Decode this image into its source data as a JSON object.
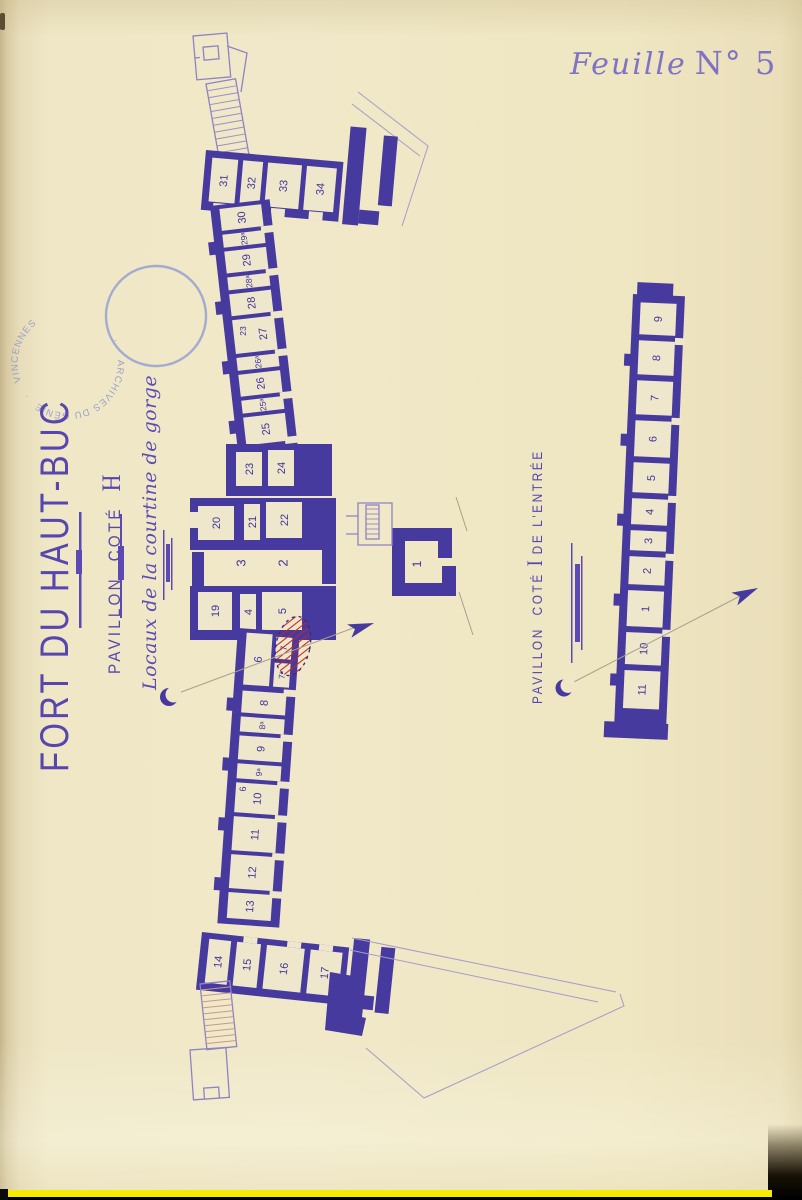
{
  "sheet": {
    "word": "Feuille",
    "number": "N° 5"
  },
  "titles": {
    "fort": "FORT DU HAUT-BUC",
    "pavillon_h": {
      "prefix": "PAVILLON",
      "mid": "COTÉ",
      "letter": "H"
    },
    "locaux": "Locaux de la courtine de gorge",
    "pavillon_i": {
      "prefix": "PAVILLON",
      "mid": "COTÉ",
      "letter": "I",
      "suffix": "DE L'ENTRÉE"
    }
  },
  "stamp": {
    "arc_top": "ARCHIVES DU GÉNIE",
    "arc_bottom": "VINCENNES"
  },
  "colors": {
    "ink": "#473a9e",
    "outline": "#8d83c6",
    "stamp_blue": "#8d97cb",
    "red_hatch": "#c3261d",
    "bottom_yellow": "#f6ea00",
    "paper": "#efe7c6"
  },
  "plans": {
    "groups": [
      {
        "id": "top-cluster",
        "t": "translate(206,150) rotate(5)",
        "slab": [
          0,
          0,
          138,
          60
        ],
        "extra": [
          [
            142,
            -36,
            16,
            98
          ],
          [
            176,
            -30,
            14,
            70
          ],
          [
            158,
            46,
            20,
            14
          ]
        ],
        "cells": [
          {
            "n": "31",
            "r": [
              7,
              7,
              26,
              44
            ]
          },
          {
            "n": "32",
            "r": [
              38,
              7,
              20,
              44
            ]
          },
          {
            "n": "33",
            "r": [
              63,
              7,
              34,
              44
            ]
          },
          {
            "n": "34",
            "r": [
              102,
              7,
              30,
              44
            ]
          }
        ],
        "doors": [
          [
            12,
            52,
            14,
            10
          ],
          [
            70,
            52,
            14,
            10
          ],
          [
            108,
            52,
            14,
            10
          ]
        ]
      },
      {
        "id": "upper-wing",
        "t": "translate(210,206) rotate(-6.5)",
        "slab": [
          0,
          0,
          60,
          248
        ],
        "cells": [
          {
            "n": "30",
            "r": [
              9,
              4,
              42,
              22
            ]
          },
          {
            "n": "29ᵃ",
            "r": [
              9,
              30,
              42,
              13
            ],
            "fs": 8.5
          },
          {
            "n": "29",
            "r": [
              9,
              47,
              42,
              22
            ]
          },
          {
            "n": "28ᵃ",
            "r": [
              9,
              73,
              42,
              13
            ],
            "fs": 8.5
          },
          {
            "n": "28",
            "r": [
              9,
              90,
              42,
              22
            ]
          },
          {
            "n": "27",
            "r": [
              9,
              116,
              42,
              34
            ],
            "lx": 38
          },
          {
            "n": "26ᵃ",
            "r": [
              9,
              154,
              42,
              13
            ],
            "fs": 8.5
          },
          {
            "n": "26",
            "r": [
              9,
              171,
              42,
              22
            ]
          },
          {
            "n": "25ᵃ",
            "r": [
              9,
              197,
              42,
              13
            ],
            "fs": 8.5
          },
          {
            "n": "25",
            "r": [
              9,
              214,
              42,
              28
            ]
          }
        ],
        "doors": [
          [
            48,
            26,
            14,
            7
          ],
          [
            48,
            69,
            14,
            7
          ],
          [
            48,
            112,
            14,
            7
          ],
          [
            48,
            150,
            14,
            7
          ],
          [
            48,
            193,
            14,
            7
          ],
          [
            48,
            238,
            14,
            7
          ]
        ],
        "butts": [
          [
            -6,
            36,
            7,
            13
          ],
          [
            -6,
            96,
            7,
            13
          ],
          [
            -6,
            156,
            7,
            13
          ],
          [
            -6,
            216,
            7,
            13
          ]
        ]
      },
      {
        "id": "middle-cluster",
        "t": "translate(0,0)",
        "extra": [
          [
            226,
            444,
            106,
            52
          ],
          [
            190,
            498,
            146,
            52
          ],
          [
            192,
            552,
            12,
            34
          ],
          [
            322,
            548,
            14,
            36
          ],
          [
            190,
            586,
            146,
            54
          ]
        ],
        "cells": [
          {
            "n": "23",
            "r": [
              236,
              452,
              26,
              34
            ]
          },
          {
            "n": "24",
            "r": [
              268,
              450,
              26,
              36
            ]
          },
          {
            "n": "20",
            "r": [
              198,
              506,
              36,
              34
            ]
          },
          {
            "n": "21",
            "r": [
              244,
              504,
              16,
              36
            ]
          },
          {
            "n": "22",
            "r": [
              266,
              502,
              36,
              36
            ]
          },
          {
            "n": "19",
            "r": [
              198,
              592,
              34,
              38
            ]
          },
          {
            "n": "4",
            "r": [
              240,
              594,
              16,
              36
            ]
          },
          {
            "n": "5",
            "r": [
              262,
              592,
              40,
              38
            ]
          }
        ],
        "doors": [
          [
            188,
            512,
            10,
            16
          ],
          [
            276,
            636,
            16,
            7
          ]
        ]
      },
      {
        "id": "lower-wing",
        "t": "translate(238,628) rotate(4)",
        "slab": [
          0,
          0,
          62,
          296
        ],
        "cells": [
          {
            "n": "6",
            "r": [
              9,
              4,
              26,
              52
            ]
          },
          {
            "n": "7",
            "r": [
              39,
              6,
              16,
              22
            ],
            "fs": 9
          },
          {
            "n": "7ᵃ",
            "r": [
              39,
              32,
              16,
              24
            ],
            "fs": 8.5
          },
          {
            "n": "8",
            "r": [
              9,
              62,
              44,
              22
            ]
          },
          {
            "n": "8ᵃ",
            "r": [
              9,
              88,
              44,
              15
            ],
            "fs": 8.5
          },
          {
            "n": "9",
            "r": [
              9,
              107,
              44,
              24
            ]
          },
          {
            "n": "9ᵃ",
            "r": [
              9,
              135,
              44,
              15
            ],
            "fs": 8.5
          },
          {
            "n": "10",
            "r": [
              9,
              154,
              44,
              30
            ]
          },
          {
            "n": "11",
            "r": [
              9,
              188,
              44,
              34
            ]
          },
          {
            "n": "12",
            "r": [
              9,
              226,
              44,
              34
            ]
          },
          {
            "n": "13",
            "r": [
              9,
              264,
              44,
              26
            ]
          }
        ],
        "doors": [
          [
            50,
            58,
            14,
            7
          ],
          [
            50,
            103,
            14,
            7
          ],
          [
            50,
            150,
            14,
            7
          ],
          [
            50,
            184,
            14,
            7
          ],
          [
            50,
            222,
            14,
            7
          ],
          [
            50,
            260,
            14,
            7
          ]
        ],
        "butts": [
          [
            -6,
            70,
            7,
            13
          ],
          [
            -6,
            130,
            7,
            13
          ],
          [
            -6,
            190,
            7,
            13
          ],
          [
            -6,
            250,
            7,
            13
          ]
        ]
      },
      {
        "id": "bottom-cluster",
        "t": "translate(202,932) rotate(6)",
        "slab": [
          0,
          0,
          148,
          58
        ],
        "extra": [
          [
            152,
            -10,
            16,
            86
          ],
          [
            180,
            -4,
            14,
            66
          ],
          [
            152,
            46,
            26,
            14
          ]
        ],
        "cells": [
          {
            "n": "14",
            "r": [
              8,
              6,
              22,
              44
            ]
          },
          {
            "n": "15",
            "r": [
              36,
              6,
              24,
              44
            ]
          },
          {
            "n": "16",
            "r": [
              66,
              6,
              38,
              44
            ]
          },
          {
            "n": "17",
            "r": [
              110,
              6,
              32,
              44
            ]
          }
        ],
        "doors": [
          [
            42,
            0,
            14,
            6
          ],
          [
            86,
            0,
            14,
            6
          ],
          [
            118,
            0,
            14,
            6
          ]
        ]
      },
      {
        "id": "entree-wing",
        "t": "translate(633,294) rotate(2.5)",
        "slab": [
          0,
          0,
          52,
          434
        ],
        "extra": [
          [
            4,
            -12,
            36,
            14
          ],
          [
            -10,
            428,
            64,
            16
          ]
        ],
        "cells": [
          {
            "n": "9",
            "r": [
              8,
              8,
              36,
              32
            ]
          },
          {
            "n": "8",
            "r": [
              8,
              46,
              36,
              34
            ]
          },
          {
            "n": "7",
            "r": [
              8,
              86,
              36,
              34
            ]
          },
          {
            "n": "6",
            "r": [
              8,
              126,
              36,
              36
            ]
          },
          {
            "n": "5",
            "r": [
              8,
              168,
              36,
              30
            ]
          },
          {
            "n": "4",
            "r": [
              8,
              204,
              36,
              26
            ]
          },
          {
            "n": "3",
            "r": [
              8,
              236,
              36,
              20
            ]
          },
          {
            "n": "2",
            "r": [
              8,
              262,
              36,
              28
            ]
          },
          {
            "n": "1",
            "r": [
              8,
              296,
              36,
              36
            ]
          },
          {
            "n": "10",
            "r": [
              8,
              338,
              36,
              32
            ]
          },
          {
            "n": "11",
            "r": [
              8,
              376,
              36,
              38
            ]
          }
        ],
        "doors": [
          [
            44,
            42,
            10,
            7
          ],
          [
            44,
            122,
            10,
            7
          ],
          [
            44,
            200,
            10,
            7
          ],
          [
            44,
            258,
            10,
            7
          ],
          [
            44,
            334,
            10,
            7
          ]
        ],
        "butts": [
          [
            -6,
            60,
            7,
            12
          ],
          [
            -6,
            140,
            7,
            12
          ],
          [
            -6,
            220,
            7,
            12
          ],
          [
            -6,
            300,
            7,
            12
          ],
          [
            -6,
            380,
            7,
            12
          ]
        ]
      }
    ],
    "annotations": [
      {
        "t": "3",
        "x": 241,
        "y": 563,
        "fs": 13
      },
      {
        "t": "2",
        "x": 283,
        "y": 563,
        "fs": 13
      },
      {
        "t": "1",
        "x": 417,
        "y": 564,
        "fs": 12
      },
      {
        "t": "23",
        "x": 243,
        "y": 331,
        "fs": 8.5
      },
      {
        "t": "6",
        "x": 243,
        "y": 789,
        "fs": 9
      }
    ]
  }
}
